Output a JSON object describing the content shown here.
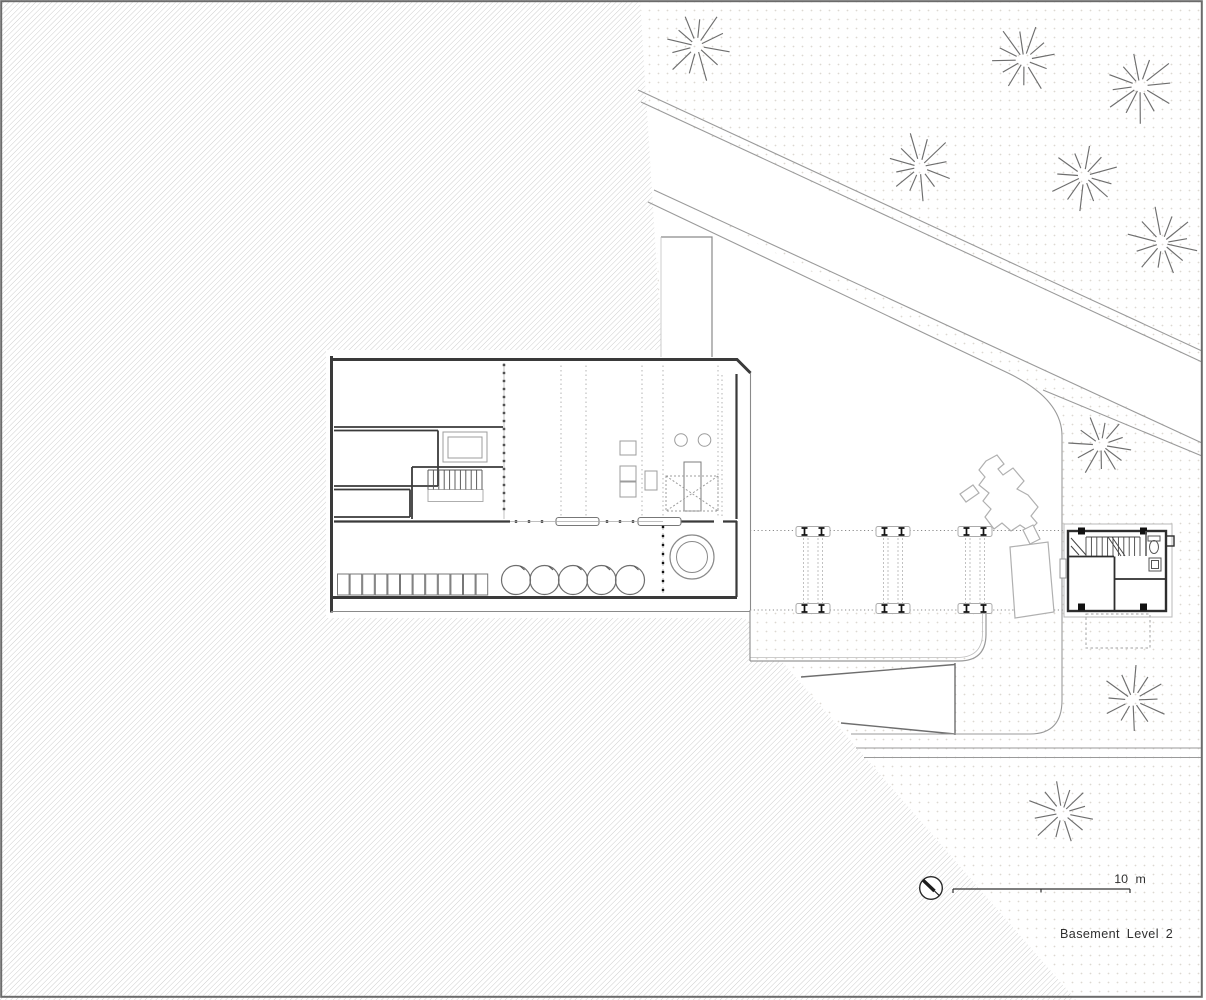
{
  "drawing": {
    "title_label": "Basement Level 2",
    "scale_label": "10 m",
    "colors": {
      "hatch": "#c9c9c9",
      "dots": "#dcd8d1",
      "wall_dark": "#3a3a3a",
      "wall_light": "#8a8a8a",
      "road": "#9a9a9a",
      "tree": "#6e6e6e",
      "equipment": "#9c9c9c",
      "machine": "#b0b0b0",
      "text": "#2f2f2f",
      "black_detail": "#111111"
    },
    "trees": [
      {
        "x": 697,
        "y": 46,
        "r": 36,
        "rot": 10
      },
      {
        "x": 1024,
        "y": 60,
        "r": 36,
        "rot": 55
      },
      {
        "x": 1140,
        "y": 86,
        "r": 38,
        "rot": 25
      },
      {
        "x": 920,
        "y": 167,
        "r": 36,
        "rot": 80
      },
      {
        "x": 1084,
        "y": 176,
        "r": 36,
        "rot": 40
      },
      {
        "x": 1162,
        "y": 243,
        "r": 37,
        "rot": 15
      },
      {
        "x": 1101,
        "y": 445,
        "r": 33,
        "rot": 65
      },
      {
        "x": 1133,
        "y": 700,
        "r": 35,
        "rot": 30
      },
      {
        "x": 1062,
        "y": 813,
        "r": 35,
        "rot": 75
      }
    ],
    "bridge": {
      "bent_centers_x": [
        813,
        893,
        975
      ],
      "frame_top_y": 526.5,
      "frame_bottom_y": 603.5,
      "frame_w": 34,
      "frame_h": 10,
      "dashed_y1": 538,
      "dashed_y2": 603,
      "guide_line_y_top": 530.5,
      "guide_line_y_bottom": 610,
      "guide_x_start": 750,
      "guide_x_end": 1064
    },
    "plan": {
      "locker_row": {
        "x0": 337.5,
        "step": 12.6,
        "w": 11.6,
        "y": 574,
        "h": 21,
        "count": 12
      },
      "tanks": {
        "centers_x": [
          516,
          544.5,
          573,
          601.5,
          630
        ],
        "y": 580,
        "r": 14.5
      },
      "big_tank": {
        "x": 692,
        "y": 557,
        "r_outer": 22,
        "r_inner": 15.5
      },
      "grid_lines_x": [
        561,
        586,
        642,
        663,
        718
      ],
      "grid_y1": 365.5,
      "grid_y2": 518.5,
      "glazing_col_x": 504,
      "glazing_col_y1": 365,
      "glazing_col_y2": 516,
      "strip_col_x": 663,
      "strip_col_y1": 527,
      "strip_col_y2": 591,
      "divider_dots": {
        "y": 521.5,
        "x1": 516,
        "x2": 658,
        "step": 13,
        "skip": [
          [
            552,
            603
          ],
          [
            634,
            685
          ]
        ]
      }
    },
    "tower": {
      "stair_treads": {
        "x0": 1086,
        "step": 5.4,
        "count": 11,
        "y1": 537,
        "y2": 556
      }
    },
    "scale_bar": {
      "x1": 953,
      "x2": 1130,
      "y": 889,
      "mid_tick_x": 1041,
      "label_x": 1130,
      "label_y": 883
    },
    "north_indicator": {
      "cx": 931,
      "cy": 888,
      "r": 11.3
    },
    "title_pos": {
      "x": 1060,
      "y": 938
    }
  }
}
